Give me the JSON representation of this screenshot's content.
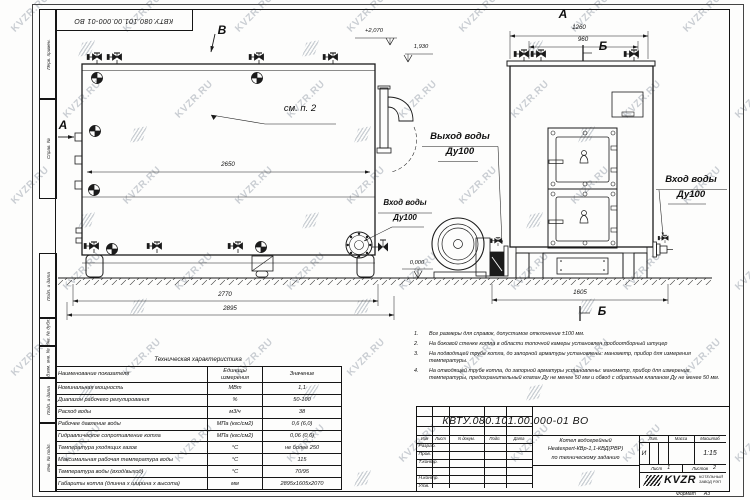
{
  "watermark": {
    "text": "KVZR.RU"
  },
  "doc_number": "КВТУ.080.101.00.000-01 ВО",
  "frame_stamps": [
    "Перв. примен.",
    "Справ. №",
    "Подп. и дата",
    "Инв. № дубл.",
    "Взам. инв. №",
    "Подп. и дата",
    "Инв. № подл."
  ],
  "drawing": {
    "view_b": "В",
    "section_a_side": "А",
    "section_a_top": "А",
    "section_b_top": "Б",
    "section_b_bottom": "Б",
    "see_note": "см. п. 2",
    "labels": {
      "outlet": [
        "Выход воды",
        "Ду100"
      ],
      "inlet_side": [
        "Вход воды",
        "Ду100"
      ],
      "inlet_front": [
        "Вход воды",
        "Ду100"
      ]
    },
    "elevations": {
      "top": "+2,070",
      "flue": "1,930",
      "ground": "0,000"
    },
    "dims": {
      "body": "2650",
      "base": "2770",
      "overall": "2895",
      "front_top": "1260",
      "front_inner": "960",
      "front_base": "1605"
    }
  },
  "notes": {
    "items": [
      {
        "num": "1.",
        "text": "Все размеры для справок, допустимое отклонение ±100 мм."
      },
      {
        "num": "2.",
        "text": "На боковой стенке котла в области топочной камеры установлен пробоотборный штуцер"
      },
      {
        "num": "3.",
        "text": "На подводящей трубе котла, до запорной арматуры установлены: манометр, прибор для измерения температуры."
      },
      {
        "num": "4.",
        "text": "На отводящей трубе котла, до запорной арматуры установлены: манометр, прибор для измерения температуры, предохранительный клапан Ду не менее 50 мм и обвод с обратным клапаном Ду не менее 50 мм."
      }
    ]
  },
  "tech_table": {
    "title": "Техническая характеристика",
    "headers": [
      "Наименование показателя",
      "Единицы измерения",
      "Значение"
    ],
    "rows": [
      [
        "Номинальная мощность",
        "МВт",
        "1,1"
      ],
      [
        "Диапазон рабочего регулирования",
        "%",
        "50-100"
      ],
      [
        "Расход воды",
        "м3/ч",
        "38"
      ],
      [
        "Рабочее давление воды",
        "МПа (кгс/см2)",
        "0,6 (6,0)"
      ],
      [
        "Гидравлическое сопротивление котла",
        "МПа (кгс/см2)",
        "0,06 (0,6)"
      ],
      [
        "Температура уходящих газов",
        "°С",
        "не более 250"
      ],
      [
        "Максимальная рабочая температура воды",
        "°С",
        "115"
      ],
      [
        "Температура воды (вход/выход)",
        "°С",
        "70/95"
      ],
      [
        "Габариты котла (длинна х ширина х высота)",
        "мм",
        "2895х1605х2070"
      ]
    ]
  },
  "title_block": {
    "header_cols": [
      "Изм",
      "Лист",
      "N докум.",
      "Подп.",
      "Дата"
    ],
    "sign_rows": [
      "Разраб.",
      "Пров.",
      "Т.контр.",
      "",
      "Н.контр.",
      "Утв."
    ],
    "title_lines": [
      "Котел водогрейный",
      "Heatexpert-КВр-1,1-КВД(РВР)",
      "по техническому заданию"
    ],
    "lit_label": "Лит.",
    "mass_label": "Масса",
    "scale_label": "Масштаб",
    "lit_value": "И",
    "scale_value": "1:15",
    "sheet_label": "Лист",
    "sheet_value": "1",
    "sheets_label": "Листов",
    "sheets_value": "2",
    "company": {
      "logo": "KVZR",
      "line1": "КОТЕЛЬНЫЙ",
      "line2": "ЗАВОД РЭП"
    },
    "format_label": "Формат",
    "format_value": "А3"
  }
}
